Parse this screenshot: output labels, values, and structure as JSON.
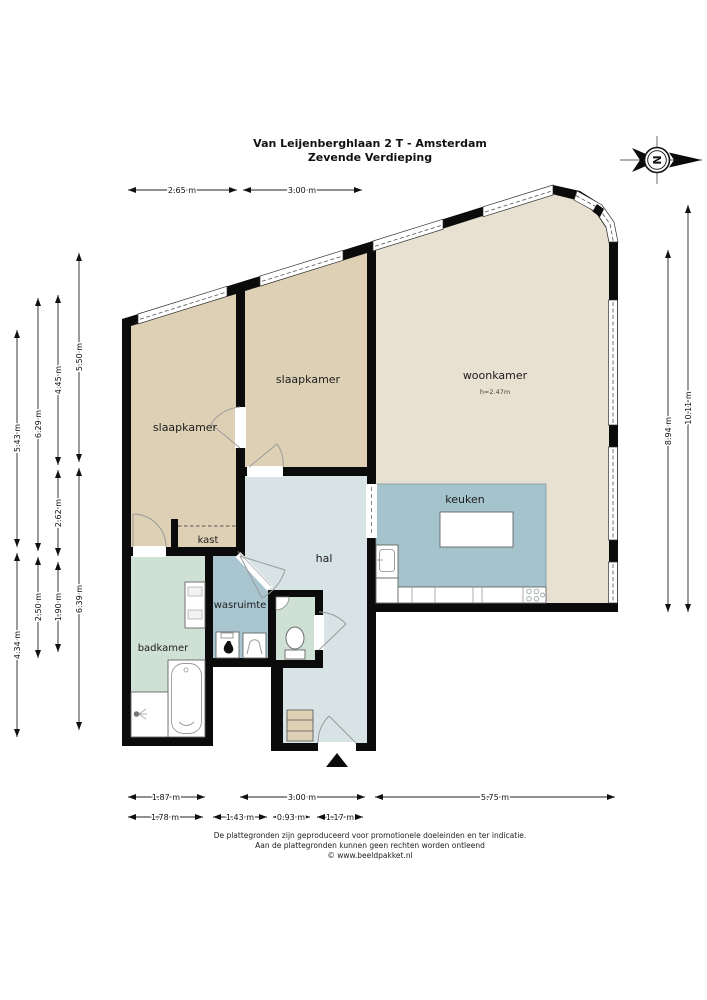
{
  "title": {
    "line1": "Van Leijenberghlaan 2 T - Amsterdam",
    "line2": "Zevende Verdieping"
  },
  "compass": {
    "letter": "N"
  },
  "rooms": {
    "slaapkamer_left": "slaapkamer",
    "slaapkamer_right": "slaapkamer",
    "woonkamer": "woonkamer",
    "woonkamer_height": "h=2.47m",
    "keuken": "keuken",
    "hal": "hal",
    "kast": "kast",
    "wasruimte": "wasruimte",
    "badkamer": "badkamer"
  },
  "dimensions": {
    "top": [
      "2.65 m",
      "3.00 m"
    ],
    "left": [
      "5.50 m",
      "4.45 m",
      "6.29 m",
      "5.43 m",
      "2.62 m",
      "2.50 m",
      "1.90 m",
      "6.39 m",
      "4.34 m"
    ],
    "right": [
      "10.11 m",
      "8.94 m"
    ],
    "bottom_row1": [
      "1.87 m",
      "3.00 m",
      "5.75 m"
    ],
    "bottom_row2": [
      "1.78 m",
      "1.43 m",
      "0.93 m",
      "1.17 m"
    ]
  },
  "footer": {
    "line1": "De plattegronden zijn geproduceerd voor promotionele doeleinden en ter indicatie.",
    "line2": "Aan de plattegronden kunnen geen rechten worden ontleend",
    "line3": "© www.beeldpakket.nl"
  },
  "colors": {
    "wall": "#0b0b0b",
    "bedroom": "#ddd0b5",
    "living": "#e8e0d1",
    "kitchen": "#a5c3cd",
    "hall": "#d8e3e5",
    "laundry": "#a9c5d0",
    "bathroom": "#cfe1d5",
    "cabinet": "#ddd0b5"
  }
}
